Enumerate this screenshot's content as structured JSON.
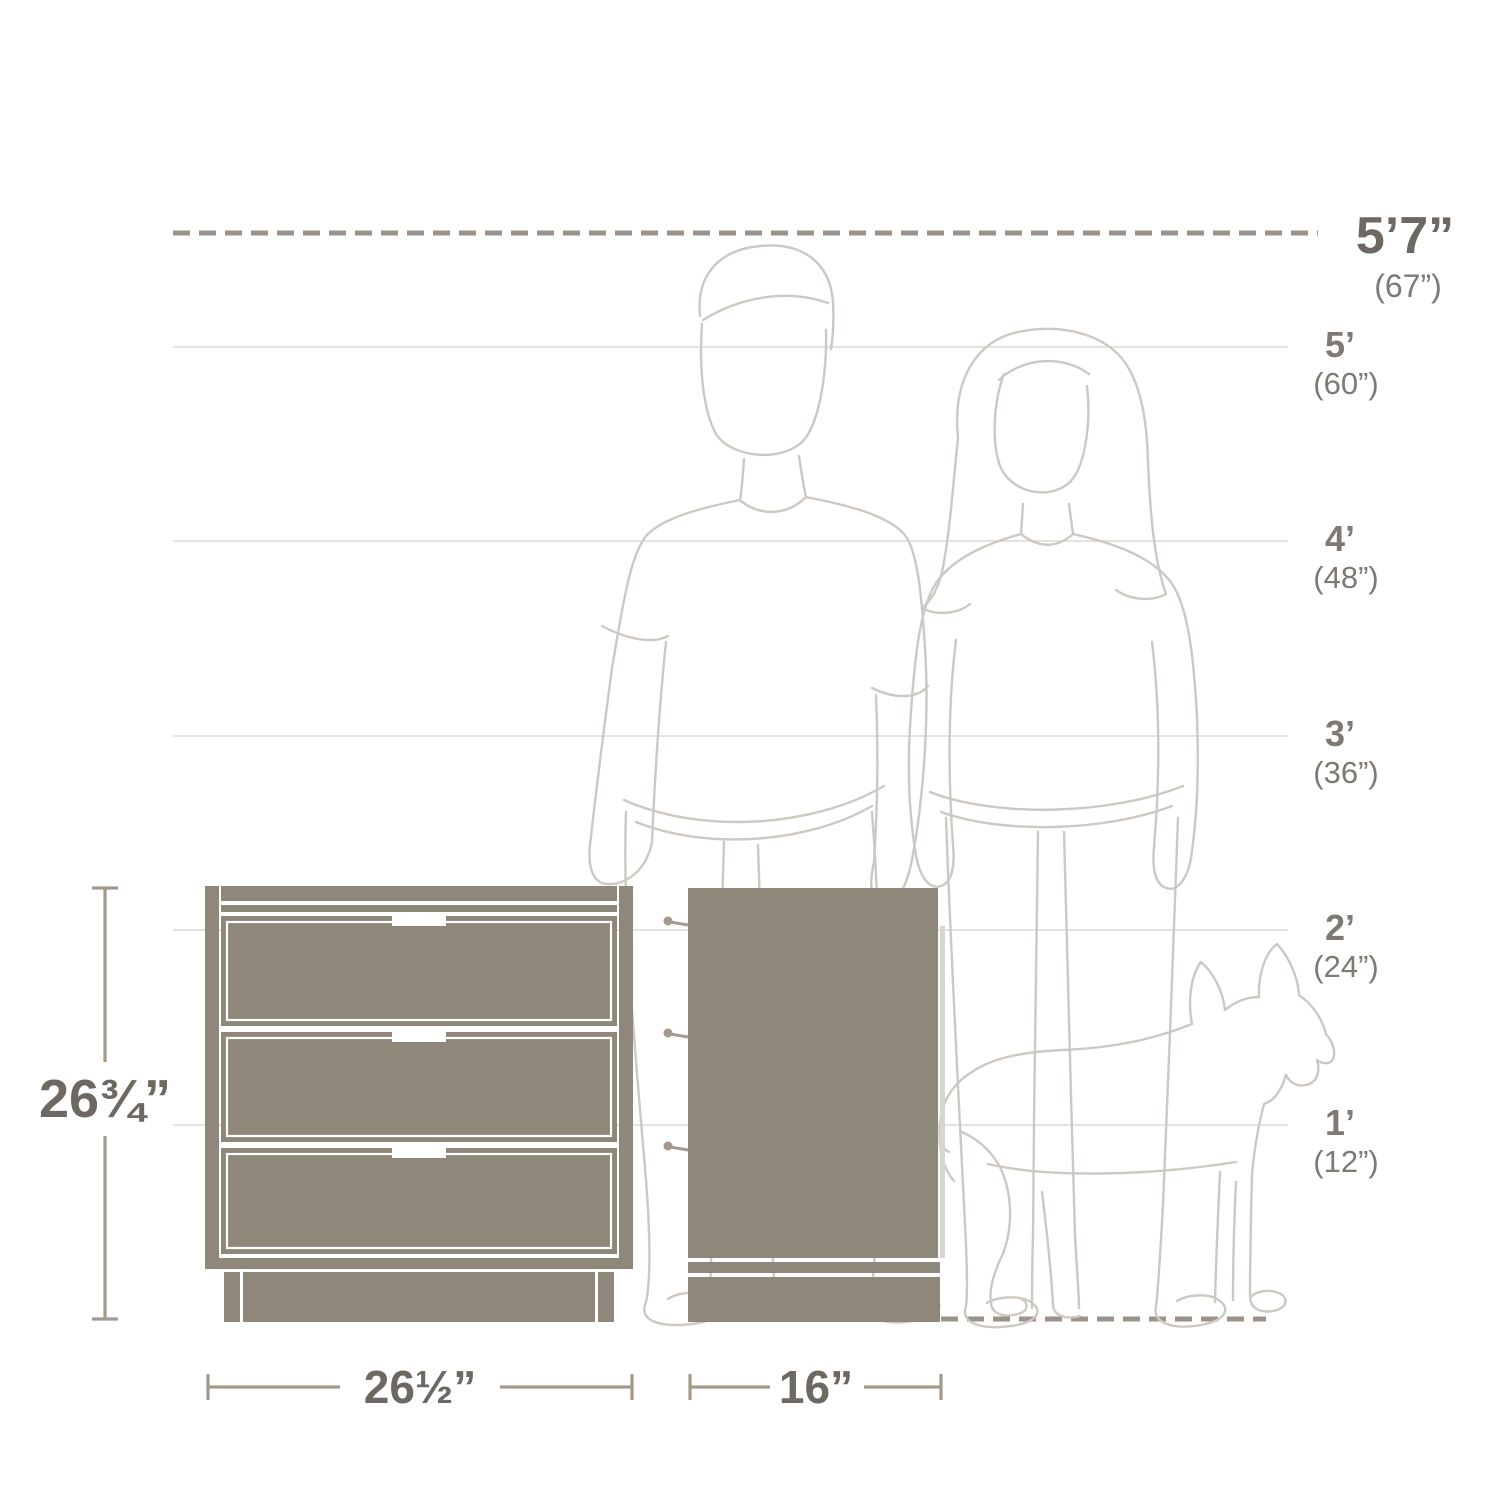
{
  "colors": {
    "taupe": "#90877b",
    "edge": "#d9d5cf",
    "figure": "#cdc8c2",
    "grid": "#dbd8d4",
    "dash": "#9c9285",
    "dim": "#a39a8d",
    "text-dark": "#6d6862",
    "text-mid": "#7e7973"
  },
  "height_scale": {
    "top_marker": {
      "feet": "5’7”",
      "inches": "(67”)"
    },
    "markers": [
      {
        "feet": "5’",
        "inches": "(60”)"
      },
      {
        "feet": "4’",
        "inches": "(48”)"
      },
      {
        "feet": "3’",
        "inches": "(36”)"
      },
      {
        "feet": "2’",
        "inches": "(24”)"
      },
      {
        "feet": "1’",
        "inches": "(12”)"
      }
    ]
  },
  "product_dimensions": {
    "height": "26¾”",
    "width": "26½”",
    "depth": "16”"
  }
}
